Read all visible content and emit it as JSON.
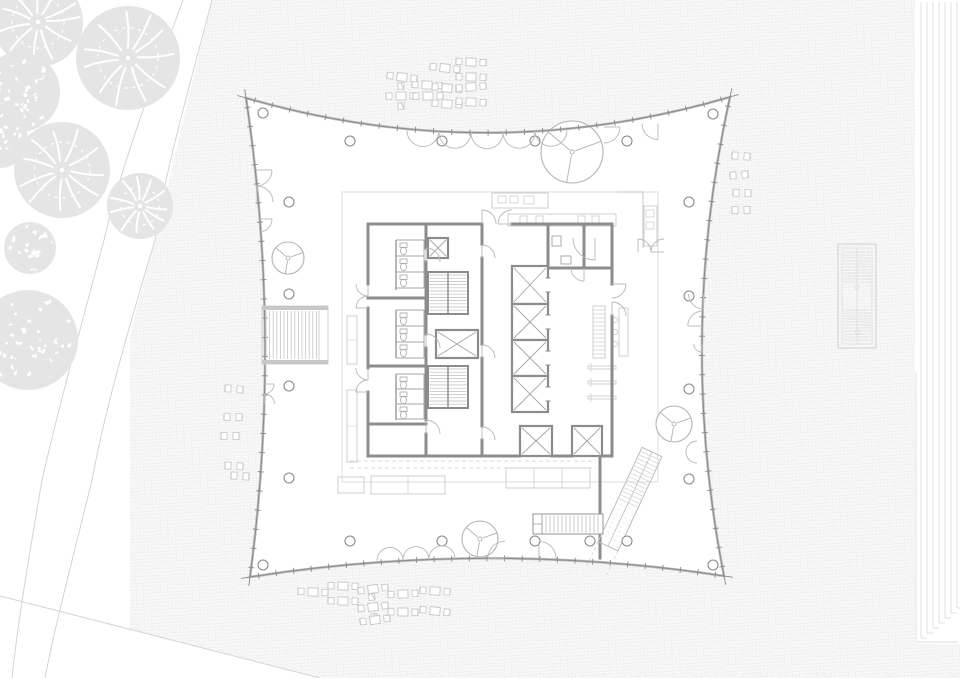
{
  "meta": {
    "title": "tower-floor-plan",
    "canvas": {
      "w": 960,
      "h": 678
    }
  },
  "colors": {
    "bg": "#ffffff",
    "paving_line": "#ececec",
    "paving_bg": "#fbfbfb",
    "canopy_fill": "#e5e5e5",
    "canopy_detail": "#ffffff",
    "path_line": "#d4d4d4",
    "facade_dark": "#8a8a8a",
    "facade_light": "#bdbdbd",
    "wall": "#8c8c8c",
    "wall_mid": "#a5a5a5",
    "light_line": "#cfcfcf",
    "lighter_line": "#dedede",
    "furniture": "#c6c6c6",
    "tree_line": "#b3b3b3",
    "arc_line": "#b8b8b8"
  },
  "site": {
    "pattern": {
      "brick_w": 7,
      "brick_h": 1.7,
      "rotate": -3
    },
    "white_left_poly": [
      [
        0,
        0
      ],
      [
        212,
        0
      ],
      [
        155,
        240
      ],
      [
        92,
        480
      ],
      [
        45,
        678
      ],
      [
        0,
        678
      ]
    ],
    "white_bottom_poly": [
      [
        0,
        596
      ],
      [
        320,
        678
      ],
      [
        0,
        678
      ]
    ],
    "path_lines": [
      "M183,0 C150,90 120,170 104,240 C80,330 58,410 42,480 C30,550 18,620 12,678",
      "M212,0 C190,85 165,170 155,240 C128,330 105,410 92,480 C75,550 55,625 45,678"
    ],
    "bottom_lines": [
      [
        0,
        596,
        320,
        678
      ]
    ],
    "right_strip": {
      "x0": 921,
      "step": 6,
      "count": 7,
      "y_top": 2,
      "y_base": 638,
      "stagger": 5,
      "border": [
        [
          916,
          372,
          916,
          642
        ],
        [
          916,
          642,
          958,
          642
        ]
      ]
    }
  },
  "canopies": [
    {
      "x": 38,
      "y": 22,
      "r": 45,
      "style": "vein"
    },
    {
      "x": 128,
      "y": 58,
      "r": 52,
      "style": "vein"
    },
    {
      "x": 20,
      "y": 92,
      "r": 40,
      "style": "speckle"
    },
    {
      "x": 62,
      "y": 170,
      "r": 48,
      "style": "vein"
    },
    {
      "x": 140,
      "y": 206,
      "r": 33,
      "style": "vein"
    },
    {
      "x": 30,
      "y": 248,
      "r": 26,
      "style": "speckle"
    },
    {
      "x": 0,
      "y": 140,
      "r": 28,
      "style": "speckle"
    },
    {
      "x": 28,
      "y": 340,
      "r": 50,
      "style": "speckle"
    }
  ],
  "building": {
    "corners": [
      [
        246,
        98
      ],
      [
        730,
        97
      ],
      [
        724,
        576
      ],
      [
        250,
        577
      ]
    ],
    "controls": {
      "top": [
        488,
        168
      ],
      "right": [
        677,
        337
      ],
      "bottom": [
        487,
        540
      ],
      "left": [
        282,
        338
      ]
    },
    "ticks": {
      "top": 27,
      "right": 25,
      "bottom": 27,
      "left": 25
    },
    "tip_len": 9
  },
  "columns": {
    "r": 5,
    "pts": [
      [
        263,
        113
      ],
      [
        350,
        141
      ],
      [
        442,
        141
      ],
      [
        535,
        141
      ],
      [
        627,
        141
      ],
      [
        713,
        114
      ],
      [
        289,
        202
      ],
      [
        289,
        294
      ],
      [
        289,
        386
      ],
      [
        289,
        478
      ],
      [
        689,
        202
      ],
      [
        689,
        296
      ],
      [
        689,
        389
      ],
      [
        689,
        479
      ],
      [
        263,
        565
      ],
      [
        350,
        541
      ],
      [
        442,
        541
      ],
      [
        535,
        541
      ],
      [
        590,
        541
      ],
      [
        627,
        541
      ],
      [
        713,
        565
      ]
    ]
  },
  "atrium_trees": [
    {
      "x": 572,
      "y": 152,
      "r": 31
    },
    {
      "x": 288,
      "y": 258,
      "r": 16
    },
    {
      "x": 480,
      "y": 539,
      "r": 18
    },
    {
      "x": 674,
      "y": 424,
      "r": 18
    }
  ],
  "facade_doors": [
    [
      423,
      130.5,
      16,
      180,
      360,
      0
    ],
    [
      455,
      132.2,
      16,
      180,
      360,
      0
    ],
    [
      487,
      132.8,
      16,
      180,
      360,
      0
    ],
    [
      519,
      132.2,
      16,
      180,
      360,
      0
    ],
    [
      551,
      130.3,
      16,
      180,
      360,
      0
    ],
    [
      604,
      127,
      16,
      0,
      90,
      1
    ],
    [
      658,
      123.5,
      16,
      90,
      180,
      1
    ],
    [
      390,
      560.5,
      13,
      0,
      180,
      0
    ],
    [
      416,
      559.5,
      13,
      0,
      180,
      0
    ],
    [
      442,
      558.8,
      13,
      0,
      180,
      0
    ],
    [
      505,
      558.2,
      17,
      180,
      270,
      1
    ],
    [
      539,
      558.4,
      17,
      270,
      360,
      1
    ],
    [
      256,
      170,
      16,
      0,
      90,
      1
    ],
    [
      257,
      202,
      16,
      270,
      360,
      1
    ],
    [
      259,
      219,
      13,
      0,
      90,
      1
    ],
    [
      264,
      384,
      10,
      0,
      90,
      1
    ],
    [
      264.5,
      404,
      10,
      270,
      360,
      1
    ],
    [
      703.5,
      294,
      15,
      90,
      180,
      1
    ],
    [
      702.8,
      326,
      15,
      180,
      270,
      1
    ],
    [
      701.8,
      344,
      8,
      90,
      180,
      1
    ],
    [
      697,
      452,
      11,
      90,
      270,
      1
    ]
  ],
  "furniture": {
    "tables_top": [
      [
        402,
        77,
        0
      ],
      [
        445,
        68,
        0
      ],
      [
        471,
        62,
        0
      ],
      [
        471,
        77,
        0
      ],
      [
        427,
        85,
        0
      ],
      [
        447,
        88,
        0
      ],
      [
        471,
        87,
        0
      ],
      [
        401,
        96,
        1
      ],
      [
        428,
        96,
        0
      ],
      [
        447,
        104,
        0
      ],
      [
        471,
        102,
        0
      ]
    ],
    "tables_bottom": [
      [
        313,
        592,
        0
      ],
      [
        343,
        586,
        0
      ],
      [
        373,
        589,
        0
      ],
      [
        403,
        594,
        0
      ],
      [
        435,
        591,
        0
      ],
      [
        343,
        601,
        0
      ],
      [
        373,
        607,
        1
      ],
      [
        403,
        612,
        0
      ],
      [
        435,
        611,
        0
      ],
      [
        375,
        620,
        0
      ]
    ],
    "chair_pairs_left": [
      [
        234,
        389
      ],
      [
        233,
        417
      ],
      [
        230,
        436
      ],
      [
        234,
        466
      ],
      [
        240,
        476
      ]
    ],
    "chair_pairs_right": [
      [
        741,
        156
      ],
      [
        739,
        175
      ],
      [
        742,
        193
      ],
      [
        741,
        210
      ]
    ]
  },
  "exterior": {
    "stair_left": {
      "x": 262,
      "y": 306,
      "w": 66,
      "h": 58
    },
    "louver": {
      "x": 838,
      "y": 244,
      "w": 38,
      "h": 104,
      "dots": [
        [
          857,
          287
        ],
        [
          857,
          332
        ]
      ]
    }
  },
  "interior": {
    "light_rect": [
      342,
      192,
      316,
      290
    ],
    "benches_v": [
      [
        347,
        316,
        10,
        48
      ],
      [
        347,
        390,
        10,
        72
      ]
    ],
    "tables": [
      [
        338,
        477,
        26,
        16
      ],
      [
        371,
        476,
        74,
        18
      ],
      [
        506,
        468,
        84,
        20
      ]
    ],
    "table_dividers": [
      [
        408,
        476,
        408,
        494
      ],
      [
        534,
        468,
        534,
        488
      ],
      [
        562,
        468,
        562,
        488
      ]
    ],
    "dashed_lines": [
      [
        350,
        461,
        596,
        461
      ],
      [
        350,
        468,
        596,
        468
      ]
    ],
    "kitchen": {
      "counters": [
        [
          492,
          193,
          56,
          15
        ],
        [
          508,
          214,
          108,
          12
        ],
        [
          644,
          206,
          13,
          40
        ]
      ],
      "appliances": [
        [
          498,
          196,
          8,
          7
        ],
        [
          510,
          196,
          8,
          7
        ],
        [
          524,
          196,
          10,
          8
        ],
        [
          520,
          216,
          7,
          7
        ],
        [
          536,
          216,
          7,
          7
        ],
        [
          578,
          216,
          7,
          7
        ],
        [
          592,
          216,
          7,
          7
        ],
        [
          646,
          210,
          8,
          7
        ],
        [
          646,
          222,
          8,
          7
        ]
      ],
      "lwall": "M617,192 L643,192 L643,248"
    },
    "shelf": {
      "rect": [
        593,
        306,
        12,
        52
      ],
      "rung_step": 4
    },
    "counter_r": [
      619,
      308,
      9,
      48
    ],
    "stools": [
      [
        615,
        320
      ],
      [
        615,
        332
      ],
      [
        615,
        344
      ]
    ],
    "bars": [
      [
        588,
        366,
        28,
        3
      ],
      [
        588,
        381,
        28,
        3
      ],
      [
        588,
        396,
        28,
        3
      ]
    ],
    "bench_slatted": {
      "x": 533,
      "y": 514,
      "w": 70,
      "h": 20,
      "slat_step": 4,
      "cap": 9
    },
    "escalator": {
      "x": 652,
      "y": 452,
      "rot": 115,
      "len": 104,
      "hw": 11,
      "tread_end": 56,
      "ext": 26
    }
  },
  "core": {
    "walls": [
      [
        368,
        224,
        482,
        224
      ],
      [
        512,
        224,
        612,
        224
      ],
      [
        368,
        224,
        368,
        284
      ],
      [
        368,
        308,
        368,
        368
      ],
      [
        368,
        392,
        368,
        456
      ],
      [
        368,
        456,
        520,
        456
      ],
      [
        552,
        456,
        572,
        456
      ],
      [
        602,
        456,
        612,
        456
      ],
      [
        612,
        224,
        612,
        284
      ],
      [
        612,
        316,
        612,
        456
      ],
      [
        426,
        224,
        426,
        248
      ],
      [
        426,
        262,
        426,
        334
      ],
      [
        426,
        348,
        426,
        420
      ],
      [
        426,
        434,
        426,
        456
      ],
      [
        482,
        224,
        482,
        244
      ],
      [
        482,
        258,
        482,
        344
      ],
      [
        482,
        358,
        482,
        426
      ],
      [
        482,
        440,
        482,
        456
      ],
      [
        368,
        298,
        426,
        298
      ],
      [
        368,
        366,
        426,
        366
      ],
      [
        368,
        424,
        426,
        424
      ],
      [
        548,
        224,
        548,
        268
      ],
      [
        548,
        268,
        612,
        268
      ],
      [
        584,
        224,
        584,
        268
      ],
      [
        600,
        456,
        600,
        558
      ]
    ],
    "stall_backs": [
      [
        396,
        240,
        396,
        290
      ],
      [
        396,
        310,
        396,
        358
      ],
      [
        396,
        374,
        396,
        420
      ]
    ],
    "shafts": [
      [
        428,
        238,
        20,
        20
      ],
      [
        436,
        330,
        42,
        28
      ],
      [
        512,
        266,
        36,
        38
      ],
      [
        512,
        304,
        36,
        36
      ],
      [
        512,
        340,
        36,
        36
      ],
      [
        512,
        376,
        36,
        36
      ],
      [
        520,
        426,
        32,
        30
      ],
      [
        572,
        426,
        30,
        30
      ]
    ],
    "stairs": [
      [
        428,
        272,
        40,
        42
      ],
      [
        428,
        366,
        40,
        42
      ]
    ],
    "stall_rows": [
      {
        "x": 396,
        "y": 240,
        "n": 3,
        "h": 16
      },
      {
        "x": 396,
        "y": 310,
        "n": 3,
        "h": 16
      },
      {
        "x": 396,
        "y": 374,
        "n": 3,
        "h": 15
      }
    ],
    "wc_extra": [
      [
        552,
        236,
        9,
        10
      ],
      [
        561,
        256,
        10,
        8
      ]
    ],
    "elevator_slits_x": 548,
    "elevator_slits_y": [
      285,
      322,
      358,
      394
    ],
    "arcs": [
      [
        482,
        224,
        14,
        270,
        360,
        1
      ],
      [
        512,
        224,
        14,
        180,
        270,
        1
      ],
      [
        368,
        284,
        12,
        90,
        180,
        1
      ],
      [
        368,
        308,
        12,
        180,
        270,
        1
      ],
      [
        368,
        368,
        12,
        90,
        180,
        1
      ],
      [
        368,
        392,
        12,
        180,
        270,
        1
      ],
      [
        426,
        262,
        14,
        270,
        360,
        1
      ],
      [
        426,
        348,
        14,
        270,
        360,
        1
      ],
      [
        426,
        434,
        14,
        270,
        360,
        1
      ],
      [
        482,
        258,
        13,
        270,
        360,
        1
      ],
      [
        482,
        358,
        13,
        270,
        360,
        1
      ],
      [
        482,
        440,
        13,
        270,
        360,
        1
      ],
      [
        595,
        238,
        22,
        90,
        180,
        1
      ],
      [
        584,
        268,
        13,
        90,
        180,
        1
      ],
      [
        612,
        284,
        14,
        0,
        90,
        1
      ],
      [
        612,
        316,
        14,
        270,
        360,
        1
      ],
      [
        600,
        516,
        16,
        90,
        180,
        1
      ],
      [
        638,
        252,
        13,
        270,
        360,
        1
      ],
      [
        664,
        252,
        13,
        180,
        270,
        1
      ]
    ]
  }
}
